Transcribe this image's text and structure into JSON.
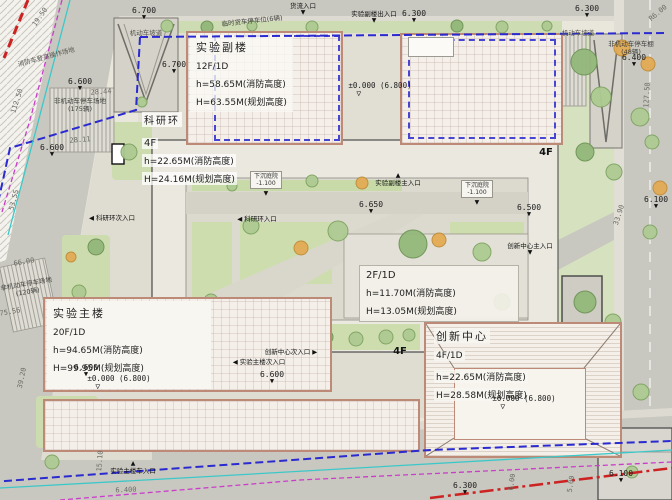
{
  "colors": {
    "building_outline": "#bd8a78",
    "inner_dashed_rect": "#4646d2",
    "site_boundary_dash": "#2a2ad0",
    "road_red_line": "#cc2222",
    "magenta_utility_line": "#c93ec9",
    "cyan_utility_line": "#3cc8c8",
    "lawn_green": "#cfdeb4",
    "road_gray": "#c9c8c0"
  },
  "buildings": [
    {
      "id": "annex",
      "name": "实验副楼",
      "floors": "12F/1D",
      "fire_height": "h=58.65M(消防高度)",
      "plan_height": "H=63.55M(规划高度)"
    },
    {
      "id": "ring",
      "name": "科研环",
      "floors": "4F",
      "fire_height": "h=22.65M(消防高度)",
      "plan_height": "H=24.16M(规划高度)"
    },
    {
      "id": "podium",
      "name": "",
      "floors": "2F/1D",
      "fire_height": "h=11.70M(消防高度)",
      "plan_height": "H=13.05M(规划高度)"
    },
    {
      "id": "main",
      "name": "实验主楼",
      "floors": "20F/1D",
      "fire_height": "h=94.65M(消防高度)",
      "plan_height": "H=99.95M(规划高度)"
    },
    {
      "id": "innovation",
      "name": "创新中心",
      "floors": "4F/1D",
      "fire_height": "h=22.65M(消防高度)",
      "plan_height": "H=28.58M(规划高度)"
    }
  ],
  "overlays": {
    "levels": [
      {
        "v": "6.700",
        "x": 144,
        "y": 7
      },
      {
        "v": "6.300",
        "x": 414,
        "y": 10
      },
      {
        "v": "6.300",
        "x": 587,
        "y": 5
      },
      {
        "v": "6.400",
        "x": 634,
        "y": 54
      },
      {
        "v": "6.600",
        "x": 80,
        "y": 78
      },
      {
        "v": "6.600",
        "x": 52,
        "y": 144
      },
      {
        "v": "6.700",
        "x": 174,
        "y": 61
      },
      {
        "v": "6.650",
        "x": 371,
        "y": 201
      },
      {
        "v": "6.500",
        "x": 529,
        "y": 204
      },
      {
        "v": "6.600",
        "x": 272,
        "y": 371
      },
      {
        "v": "6.600",
        "x": 86,
        "y": 364
      },
      {
        "v": "6.300",
        "x": 465,
        "y": 482
      },
      {
        "v": "6.100",
        "x": 621,
        "y": 470
      },
      {
        "v": "6.100",
        "x": 656,
        "y": 196
      }
    ],
    "datum": [
      {
        "t": "±0.000 (6.800)",
        "x": 380,
        "y": 82
      },
      {
        "t": "±0.000 (6.800)",
        "x": 119,
        "y": 375
      },
      {
        "t": "±0.000 (6.800)",
        "x": 524,
        "y": 395
      }
    ],
    "entrances": [
      {
        "t": "货流入口",
        "x": 303,
        "y": 3,
        "a": "down"
      },
      {
        "t": "实验副楼出入口",
        "x": 374,
        "y": 11,
        "a": "down"
      },
      {
        "t": "实验副楼主入口",
        "x": 398,
        "y": 173,
        "a": "up"
      },
      {
        "t": "科研环次入口",
        "x": 112,
        "y": 215,
        "a": "left"
      },
      {
        "t": "科研环入口",
        "x": 257,
        "y": 216,
        "a": "left"
      },
      {
        "t": "创新中心主入口",
        "x": 530,
        "y": 243,
        "a": "down"
      },
      {
        "t": "创新中心次入口",
        "x": 291,
        "y": 349,
        "a": "right"
      },
      {
        "t": "实验主楼次入口",
        "x": 259,
        "y": 359,
        "a": "left"
      },
      {
        "t": "实验主楼车入口",
        "x": 133,
        "y": 461,
        "a": "up"
      }
    ],
    "parking": [
      {
        "lines": [
          "临时货车停车位(6辆)"
        ],
        "x": 252,
        "y": 17,
        "rot": -6
      },
      {
        "lines": [
          "非机动车停车场地",
          "(175辆)"
        ],
        "x": 80,
        "y": 97,
        "rot": 0
      },
      {
        "lines": [
          "非机动车停车棚",
          "(48辆)"
        ],
        "x": 631,
        "y": 40,
        "rot": 0
      },
      {
        "lines": [
          "非机动车停车场地",
          "(120辆)"
        ],
        "x": 27,
        "y": 280,
        "rot": -10
      }
    ],
    "ramps": [
      {
        "t": "机动车坡道",
        "x": 146,
        "y": 27,
        "rot": 0
      },
      {
        "t": "机动车坡道",
        "x": 578,
        "y": 27,
        "rot": 0
      },
      {
        "t": "消防车登高操作场地",
        "x": 46,
        "y": 51,
        "rot": -15
      }
    ],
    "dims": [
      {
        "v": "19.50",
        "x": 40,
        "y": 13,
        "rot": -55
      },
      {
        "v": "112.50",
        "x": 17,
        "y": 97,
        "rot": -72
      },
      {
        "v": "28.44",
        "x": 101,
        "y": 88,
        "rot": -4
      },
      {
        "v": "28.11",
        "x": 80,
        "y": 136,
        "rot": -4
      },
      {
        "v": "53.55",
        "x": 14,
        "y": 196,
        "rot": -75
      },
      {
        "v": "66.00",
        "x": 24,
        "y": 258,
        "rot": -10
      },
      {
        "v": "75.56",
        "x": 10,
        "y": 308,
        "rot": -10
      },
      {
        "v": "39.20",
        "x": 22,
        "y": 374,
        "rot": -78
      },
      {
        "v": "15.10",
        "x": 100,
        "y": 457,
        "rot": -85
      },
      {
        "v": "33.90",
        "x": 619,
        "y": 211,
        "rot": -72
      },
      {
        "v": "127.50",
        "x": 647,
        "y": 91,
        "rot": -87
      },
      {
        "v": "R6.00",
        "x": 658,
        "y": 9,
        "rot": -40
      },
      {
        "v": "6.00",
        "x": 512,
        "y": 478,
        "rot": -82
      },
      {
        "v": "5.00",
        "x": 571,
        "y": 480,
        "rot": -82
      },
      {
        "v": "6.400",
        "x": 126,
        "y": 486,
        "rot": -2
      }
    ],
    "sunken": [
      {
        "lines": [
          "下沉庭院",
          "-1.100"
        ],
        "x": 266,
        "y": 171
      },
      {
        "lines": [
          "下沉庭院",
          "-1.100"
        ],
        "x": 477,
        "y": 180
      }
    ],
    "misc": [
      {
        "t": "4F",
        "x": 546,
        "y": 147
      },
      {
        "t": "4F",
        "x": 400,
        "y": 346
      }
    ]
  }
}
